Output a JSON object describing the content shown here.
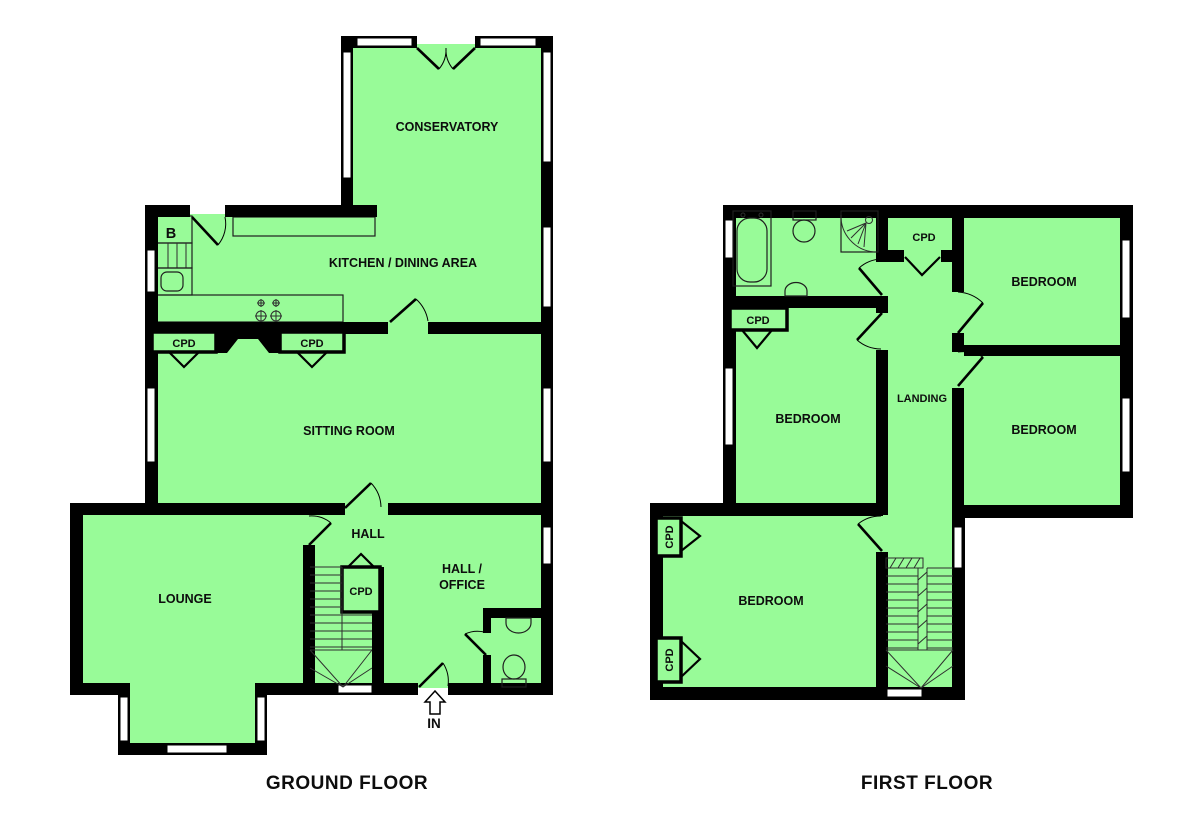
{
  "page": {
    "background": "#ffffff"
  },
  "palette": {
    "room_fill": "#98fb98",
    "wall": "#000000",
    "window": "#ffffff",
    "label_text": "#0d0d0d"
  },
  "ground_floor": {
    "title": "GROUND FLOOR",
    "labels": {
      "conservatory": "CONSERVATORY",
      "kitchen_dining": "KITCHEN / DINING AREA",
      "sitting_room": "SITTING ROOM",
      "lounge": "LOUNGE",
      "hall": "HALL",
      "hall_office_line1": "HALL /",
      "hall_office_line2": "OFFICE",
      "cupboard_left": "CPD",
      "cupboard_right": "CPD",
      "cupboard_stairs": "CPD",
      "boiler": "B",
      "entrance": "IN"
    }
  },
  "first_floor": {
    "title": "FIRST FLOOR",
    "labels": {
      "landing": "LANDING",
      "bedroom_top_right": "BEDROOM",
      "bedroom_mid_right": "BEDROOM",
      "bedroom_left": "BEDROOM",
      "bedroom_bottom": "BEDROOM",
      "cupboard_landing": "CPD",
      "cupboard_bathroom": "CPD",
      "cupboard_bedroom_top": "CPD",
      "cupboard_bedroom_bottom": "CPD"
    }
  }
}
